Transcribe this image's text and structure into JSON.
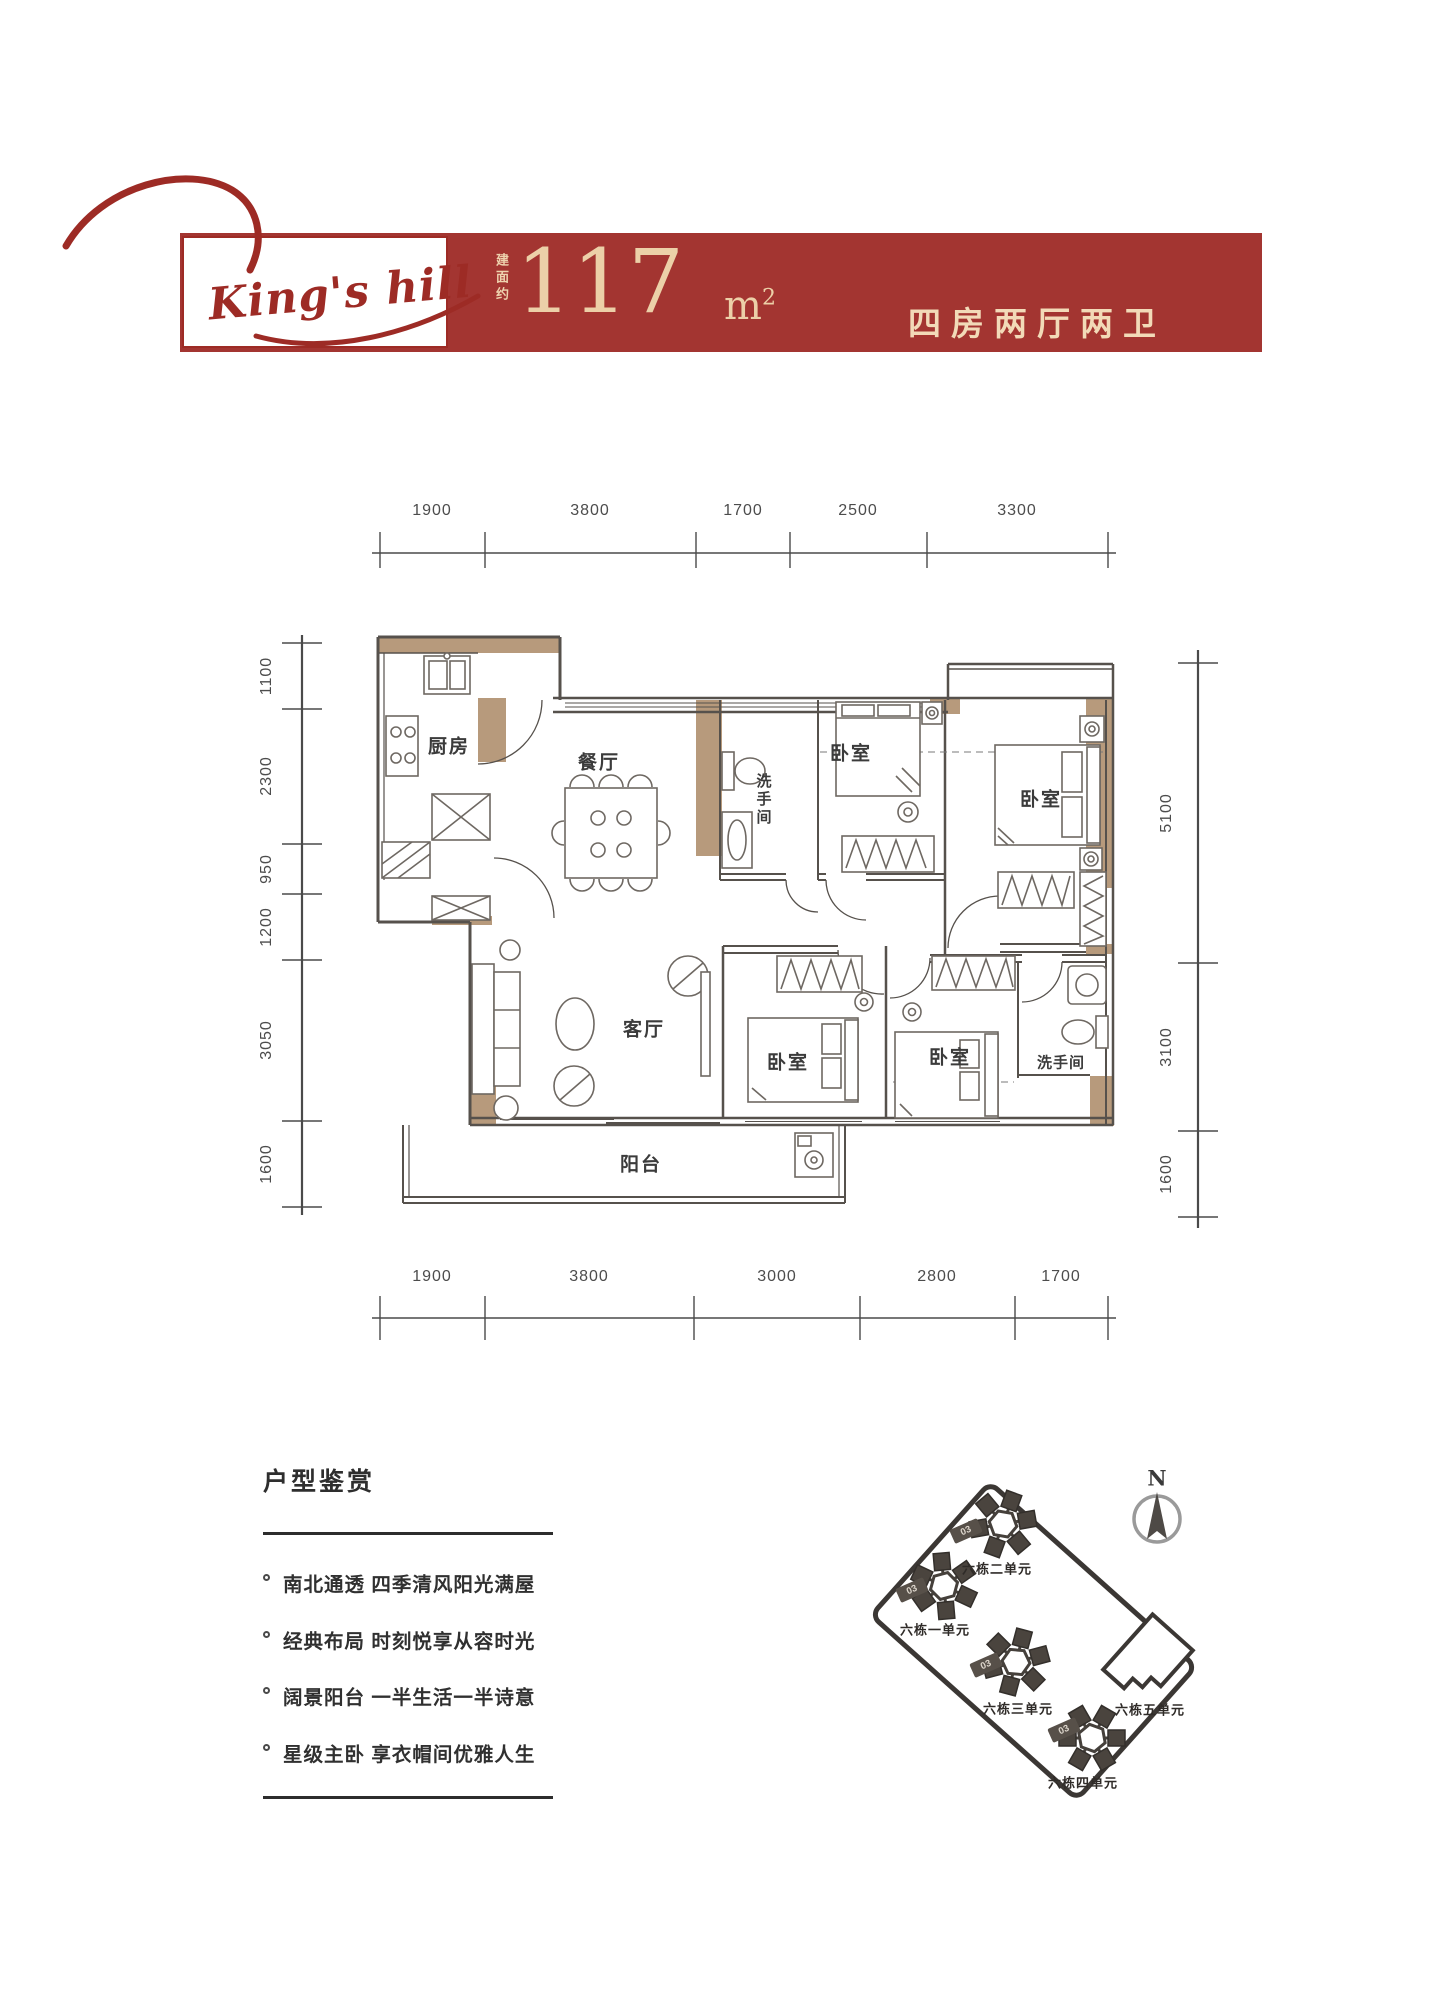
{
  "header": {
    "logo_text": "King's hill",
    "area_prefix": "建面约",
    "area_value": "117",
    "area_unit_base": "m",
    "area_unit_sup": "2",
    "unit_layout": "四房两厅两卫"
  },
  "floorplan": {
    "labels": {
      "kitchen": "厨房",
      "dining": "餐厅",
      "bathroom": "洗手间",
      "bedroom": "卧室",
      "living": "客厅",
      "balcony": "阳台"
    },
    "dims": {
      "top": [
        "1900",
        "3800",
        "1700",
        "2500",
        "3300"
      ],
      "bottom": [
        "1900",
        "3800",
        "3000",
        "2800",
        "1700"
      ],
      "left": [
        "1100",
        "2300",
        "950",
        "1200",
        "3050",
        "1600"
      ],
      "right": [
        "5100",
        "3100",
        "1600"
      ]
    }
  },
  "features": {
    "title": "户型鉴赏",
    "items": [
      "南北通透 四季清风阳光满屋",
      "经典布局 时刻悦享从容时光",
      "阔景阳台 一半生活一半诗意",
      "星级主卧 享衣帽间优雅人生"
    ]
  },
  "siteplan": {
    "north_label": "N",
    "units": [
      {
        "name": "六栋二单元",
        "badge": "03"
      },
      {
        "name": "六栋一单元",
        "badge": "03"
      },
      {
        "name": "六栋三单元",
        "badge": "03"
      },
      {
        "name": "六栋四单元",
        "badge": "03"
      },
      {
        "name": "六栋五单元",
        "badge": ""
      }
    ]
  }
}
